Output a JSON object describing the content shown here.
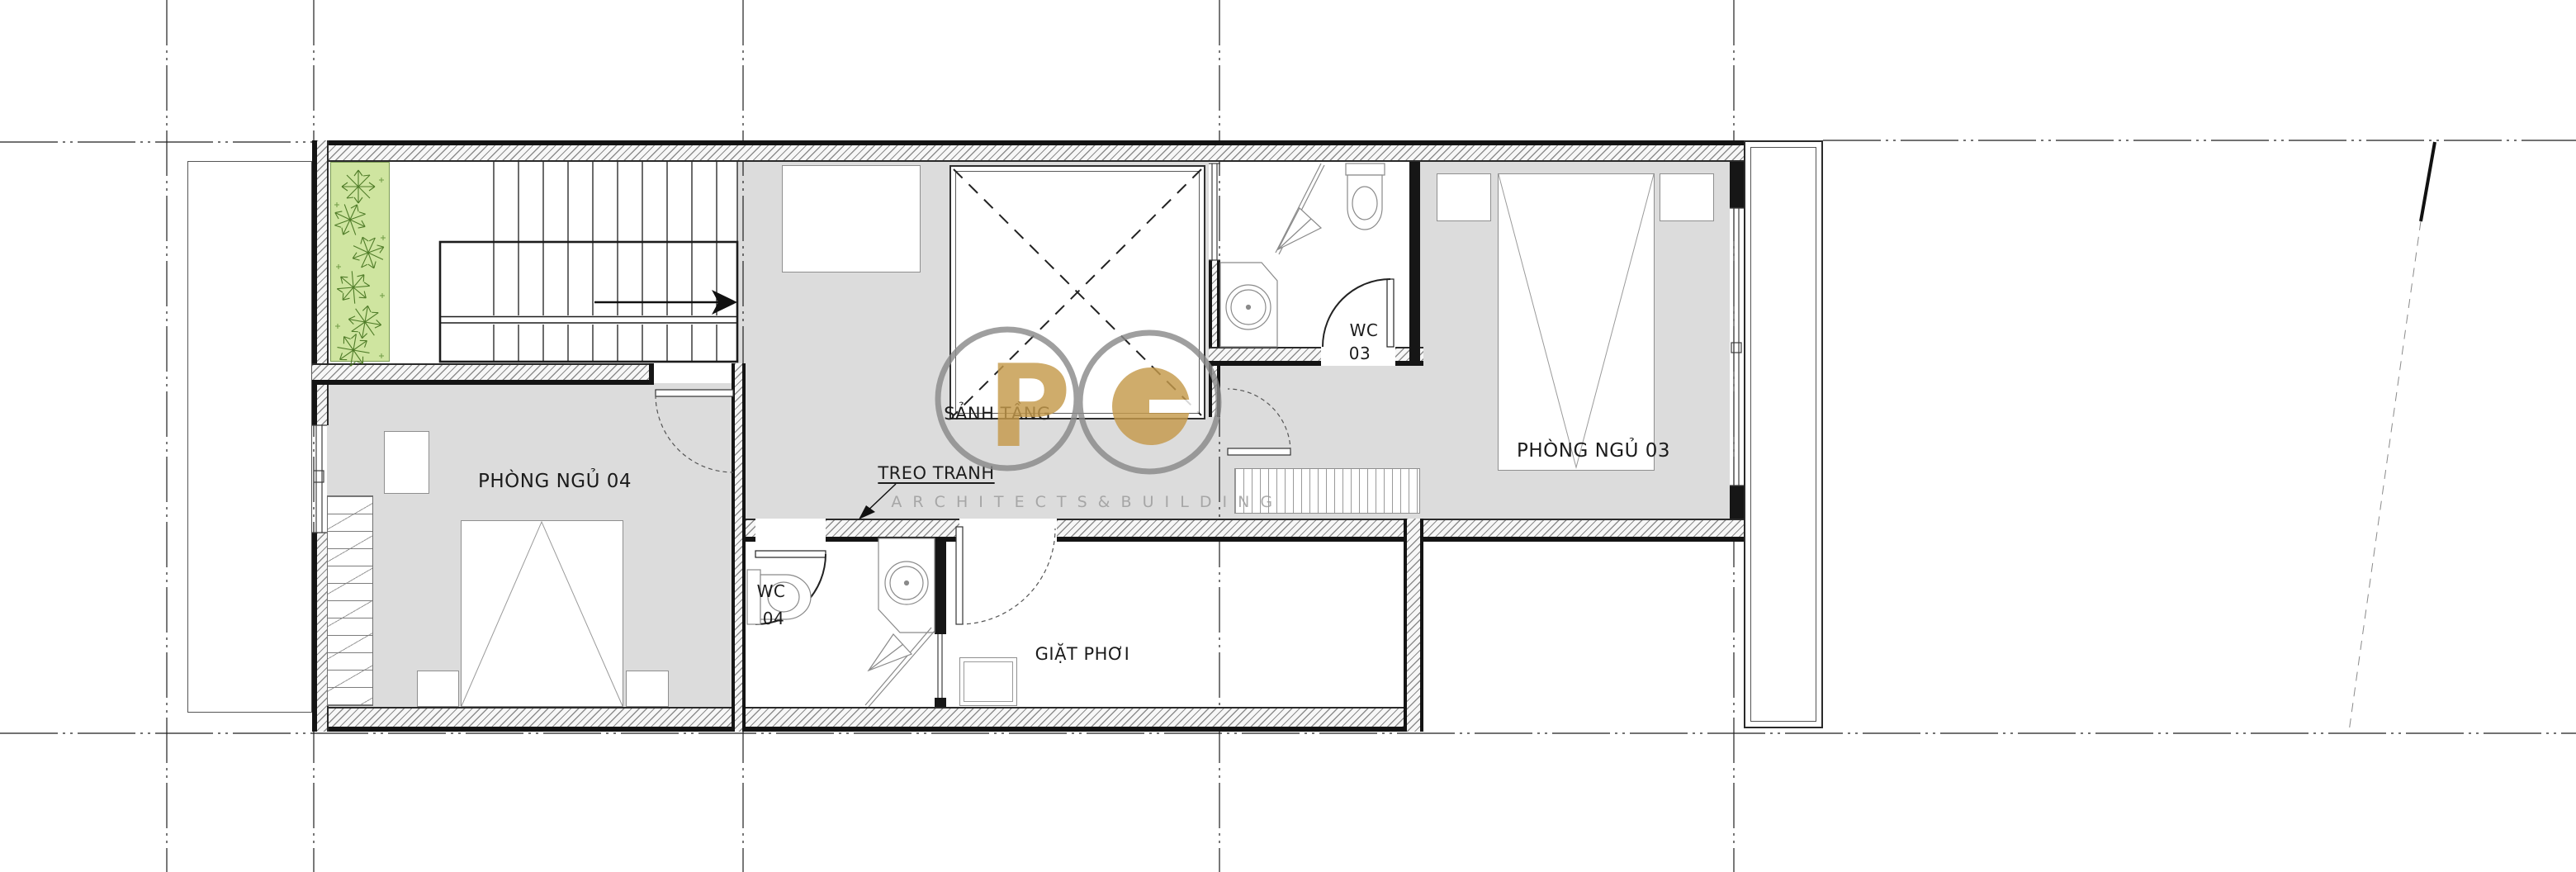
{
  "drawing": {
    "kind": "architectural floor plan",
    "rooms": {
      "bedroom04": {
        "label": "PHÒNG NGỦ 04"
      },
      "bedroom03": {
        "label": "PHÒNG NGỦ 03"
      },
      "hall": {
        "label": "SẢNH TẦNG"
      },
      "laundry": {
        "label": "GIẶT PHƠI"
      },
      "wc03": {
        "line1": "WC",
        "line2": "03"
      },
      "wc04": {
        "line1": "WC",
        "line2": "04"
      }
    },
    "annotations": {
      "picture_wall": {
        "label": "TREO TRANH"
      }
    },
    "watermark": {
      "letter_p": "P",
      "letter_c": "C",
      "subtitle": "A R C H I T E C T S & B U I L D I N G"
    },
    "colors": {
      "floor_gray": "#dcdcdc",
      "planter_green": "#cfe5a0",
      "plant_stroke": "#4f7c28",
      "logo_gold": "#c59a4b",
      "logo_circle_gray": "#8a8a8a",
      "subtitle_gray": "#9b9b9b",
      "wall_black": "#161616"
    }
  }
}
